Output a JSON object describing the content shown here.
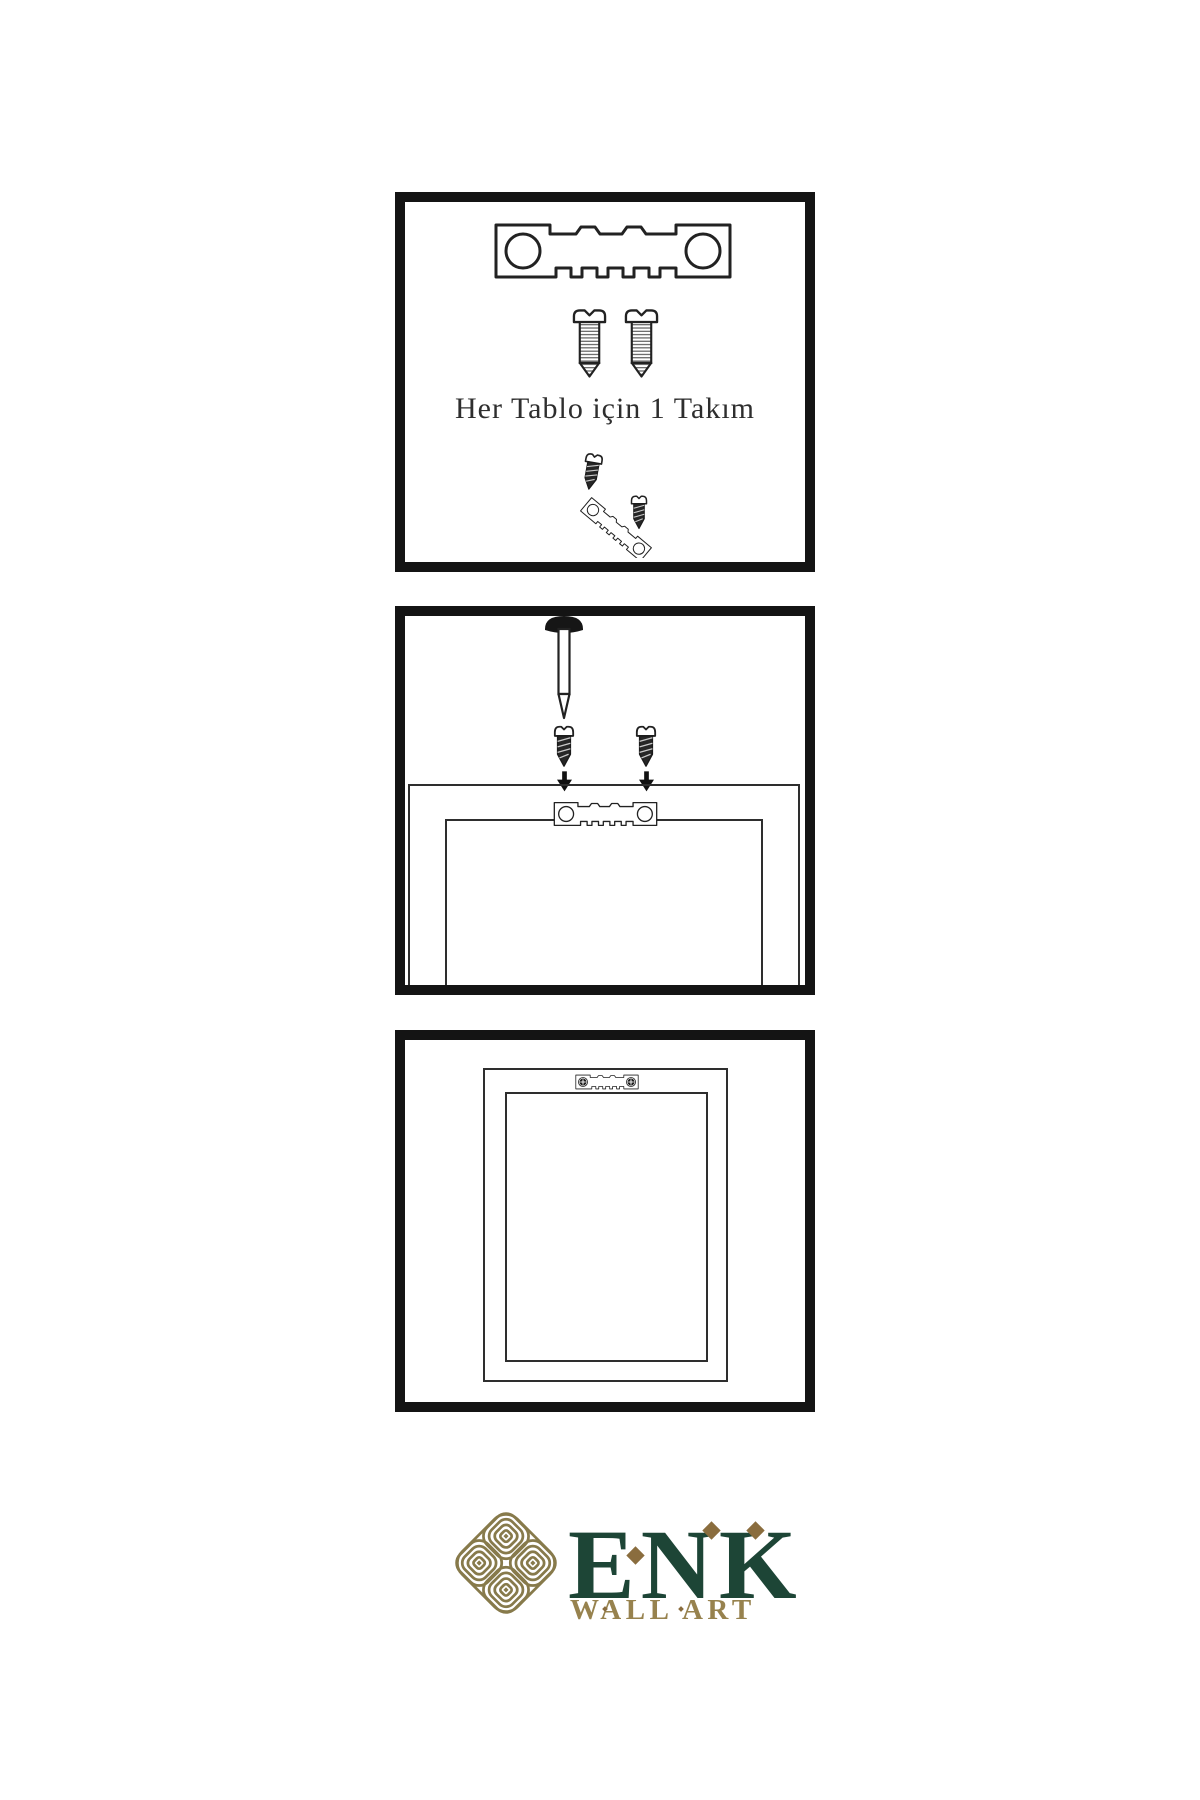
{
  "background_color": "#ffffff",
  "line_color": "#222222",
  "panel_border_color": "#141414",
  "steps": [
    {
      "id": 1,
      "caption": "Her Tablo için 1 Takım",
      "contents": [
        "sawtooth-hanger",
        "screw",
        "screw",
        "screw-hanger-assembly"
      ]
    },
    {
      "id": 2,
      "contents": [
        "wall-nail",
        "screw",
        "screw",
        "down-arrow",
        "down-arrow",
        "sawtooth-hanger-on-frame",
        "frame-back-outline"
      ]
    },
    {
      "id": 3,
      "contents": [
        "frame-back-outline",
        "installed-sawtooth-hanger"
      ]
    }
  ],
  "brand": {
    "name": "ENK",
    "subtitle": "WALL ART",
    "knot_color": "#877a4b",
    "name_color": "#1d4536",
    "accent_color": "#8a6d3e",
    "subtitle_color": "#97824e"
  }
}
